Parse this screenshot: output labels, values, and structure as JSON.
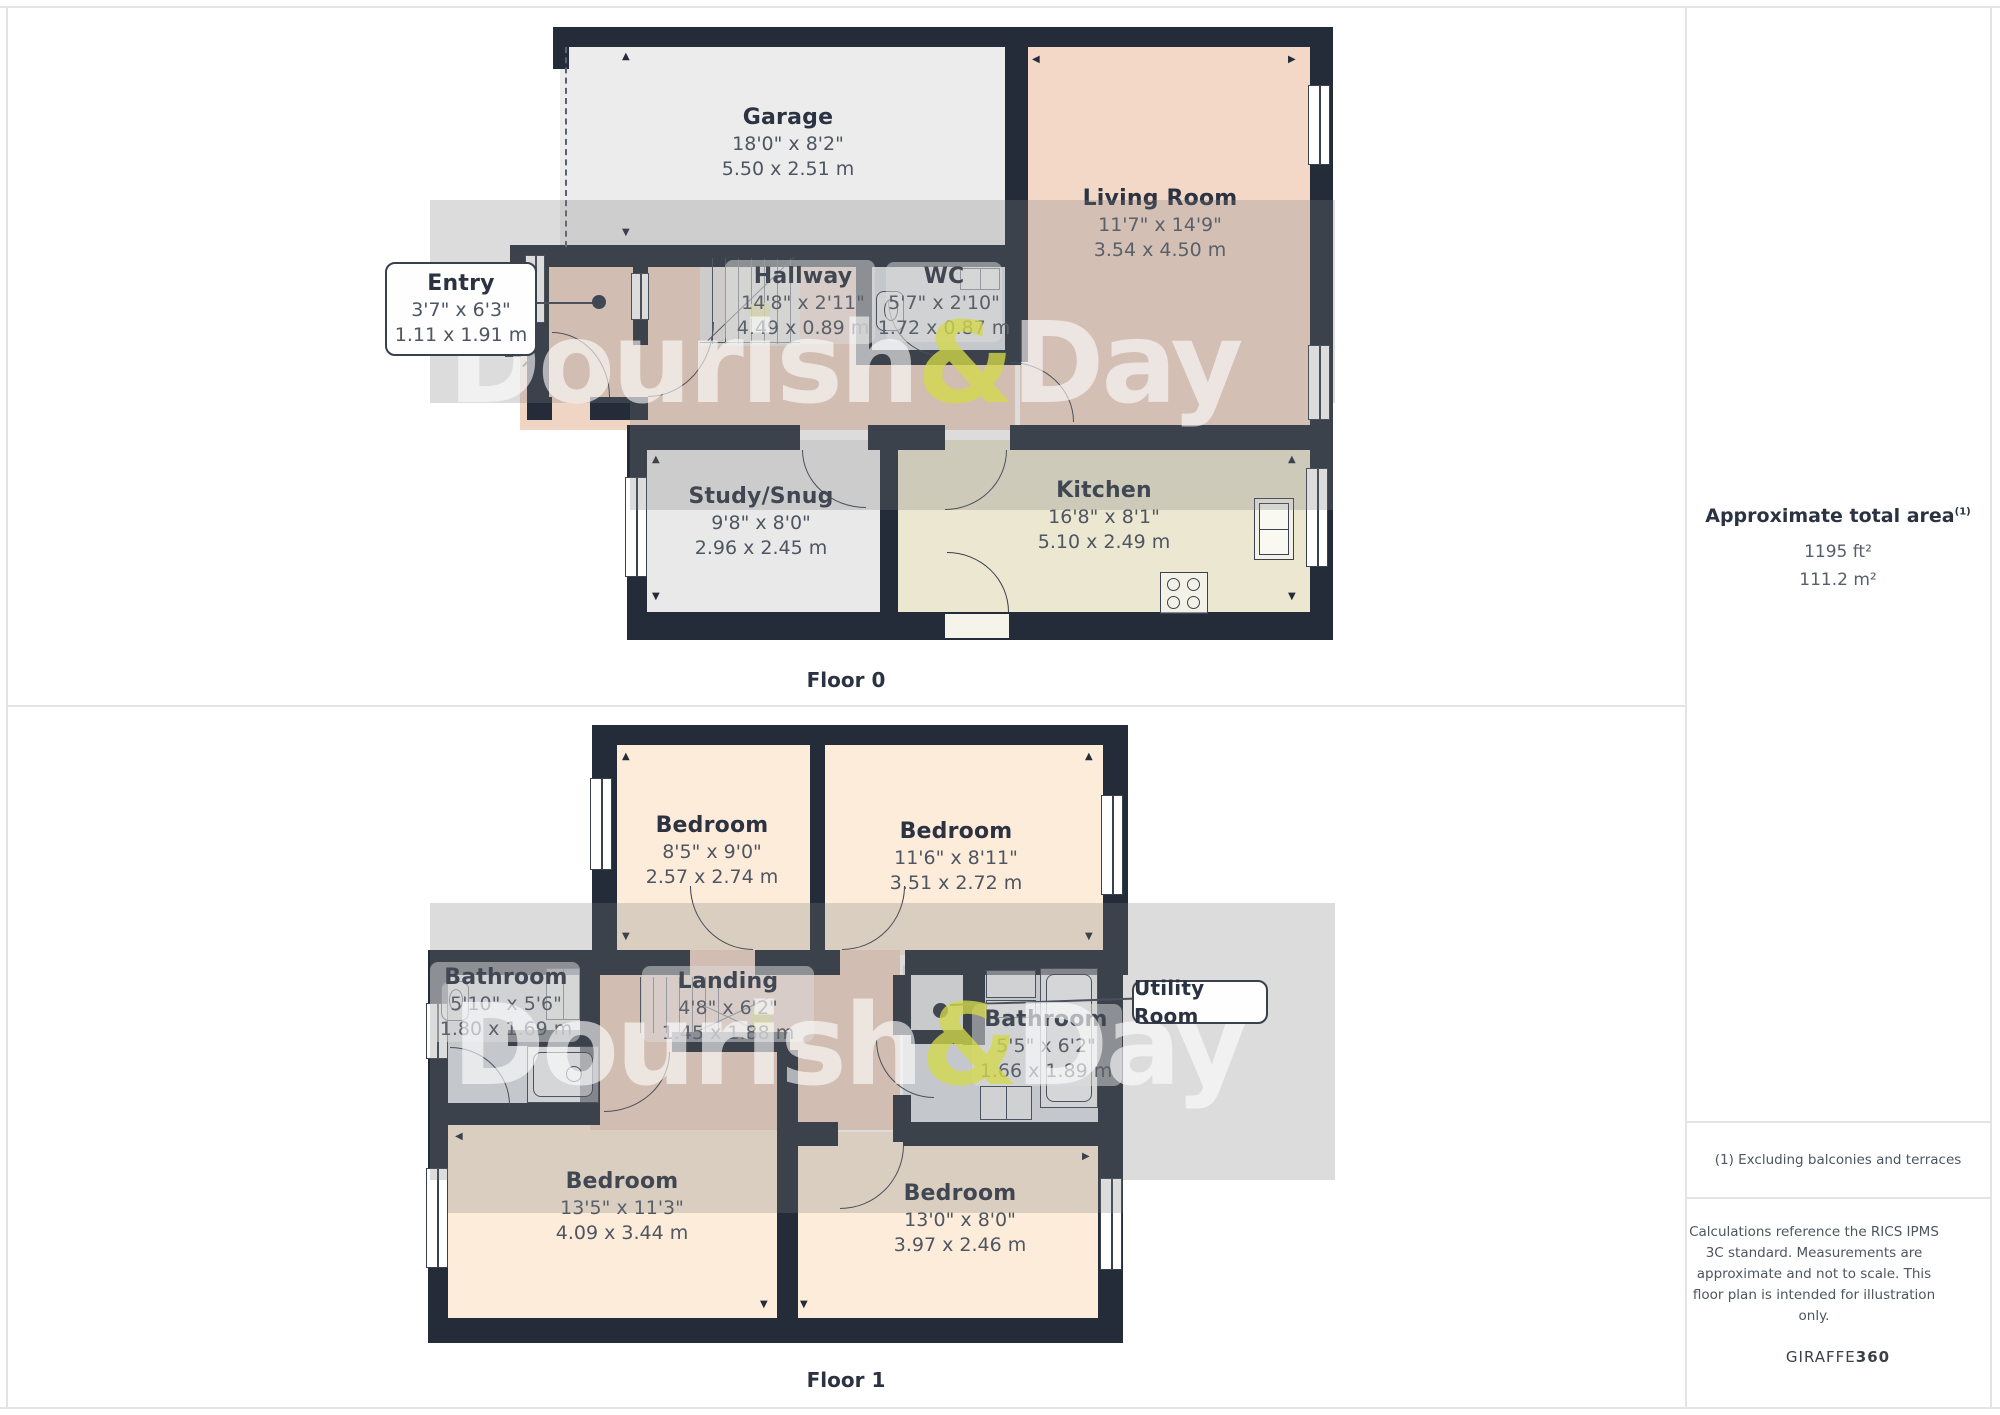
{
  "floor0": {
    "label": "Floor 0",
    "garage": {
      "name": "Garage",
      "imperial": "18'0\" x 8'2\"",
      "metric": "5.50 x 2.51 m"
    },
    "living": {
      "name": "Living Room",
      "imperial": "11'7\" x 14'9\"",
      "metric": "3.54 x 4.50 m"
    },
    "entry": {
      "name": "Entry",
      "imperial": "3'7\" x 6'3\"",
      "metric": "1.11 x 1.91 m"
    },
    "hallway": {
      "name": "Hallway",
      "imperial": "14'8\" x 2'11\"",
      "metric": "4.49 x 0.89 m"
    },
    "wc": {
      "name": "WC",
      "imperial": "5'7\" x 2'10\"",
      "metric": "1.72 x 0.87 m"
    },
    "study": {
      "name": "Study/Snug",
      "imperial": "9'8\" x 8'0\"",
      "metric": "2.96 x 2.45 m"
    },
    "kitchen": {
      "name": "Kitchen",
      "imperial": "16'8\" x 8'1\"",
      "metric": "5.10 x 2.49 m"
    }
  },
  "floor1": {
    "label": "Floor 1",
    "bedroom_tl": {
      "name": "Bedroom",
      "imperial": "8'5\" x 9'0\"",
      "metric": "2.57 x 2.74 m"
    },
    "bedroom_tr": {
      "name": "Bedroom",
      "imperial": "11'6\" x 8'11\"",
      "metric": "3.51 x 2.72 m"
    },
    "bathroom_left": {
      "name": "Bathroom",
      "imperial": "5'10\" x 5'6\"",
      "metric": "1.80 x 1.69 m"
    },
    "landing": {
      "name": "Landing",
      "imperial": "4'8\" x 6'2\"",
      "metric": "1.45 x 1.88 m"
    },
    "bathroom_right": {
      "name": "Bathroom",
      "imperial": "5'5\" x 6'2\"",
      "metric": "1.66 x 1.89 m"
    },
    "utility": {
      "name": "Utility Room"
    },
    "bedroom_bl": {
      "name": "Bedroom",
      "imperial": "13'5\" x 11'3\"",
      "metric": "4.09 x 3.44 m"
    },
    "bedroom_br": {
      "name": "Bedroom",
      "imperial": "13'0\" x 8'0\"",
      "metric": "3.97 x 2.46 m"
    }
  },
  "sidebar": {
    "title": "Approximate total area",
    "title_sup": "(1)",
    "area_ft": "1195 ft²",
    "area_m": "111.2 m²",
    "footnote": "(1) Excluding balconies and terraces",
    "disclaimer": "Calculations reference the RICS IPMS 3C standard. Measurements are approximate and not to scale. This floor plan is intended for illustration only.",
    "brand_name": "GIRAFFE",
    "brand_suffix": "360"
  },
  "watermark": {
    "part1": "Dourish",
    "amp": "&",
    "part2": "Day"
  },
  "colors": {
    "wall": "#242c39",
    "living_pink": "#f3d8c7",
    "bedroom_peach": "#fdecd9",
    "kitchen_khaki": "#ece7d1",
    "bath_blue": "#dfe3ea",
    "garage_gray": "#ececec",
    "watermark_amp": "#d3d94a"
  }
}
